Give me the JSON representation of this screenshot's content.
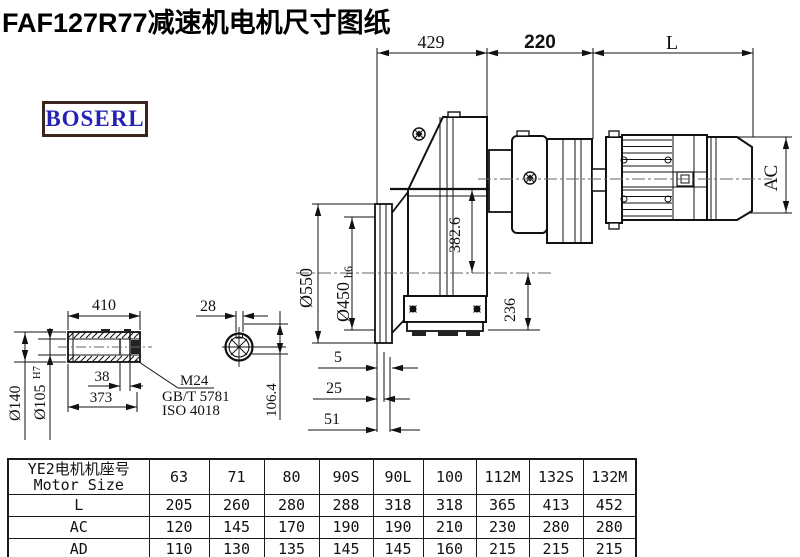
{
  "title": "FAF127R77减速机电机尺寸图纸",
  "brand": "BOSERL",
  "drawing": {
    "dim_429": "429",
    "dim_220": "220",
    "dim_l": "L",
    "dim_ac": "AC",
    "dim_550": "Ø550",
    "dim_450": "Ø450",
    "dim_450_tol": "h6",
    "dim_382_6": "382.6",
    "dim_236": "236",
    "dim_5": "5",
    "dim_25": "25",
    "dim_51": "51"
  },
  "shaft_detail": {
    "dim_410": "410",
    "dim_28": "28",
    "dim_140": "Ø140",
    "dim_105": "Ø105",
    "dim_105_tol": "H7",
    "dim_38": "38",
    "dim_373": "373",
    "note_m24": "M24",
    "note_gb": "GB/T 5781",
    "note_iso": "ISO 4018",
    "dim_106_4": "106.4"
  },
  "table": {
    "header_cn": "YE2电机机座号",
    "header_en": "Motor Size",
    "columns": [
      "63",
      "71",
      "80",
      "90S",
      "90L",
      "100",
      "112M",
      "132S",
      "132M"
    ],
    "rows": [
      {
        "label": "L",
        "values": [
          "205",
          "260",
          "280",
          "288",
          "318",
          "318",
          "365",
          "413",
          "452"
        ]
      },
      {
        "label": "AC",
        "values": [
          "120",
          "145",
          "170",
          "190",
          "190",
          "210",
          "230",
          "280",
          "280"
        ]
      },
      {
        "label": "AD",
        "values": [
          "110",
          "130",
          "135",
          "145",
          "145",
          "160",
          "215",
          "215",
          "215"
        ]
      }
    ]
  }
}
